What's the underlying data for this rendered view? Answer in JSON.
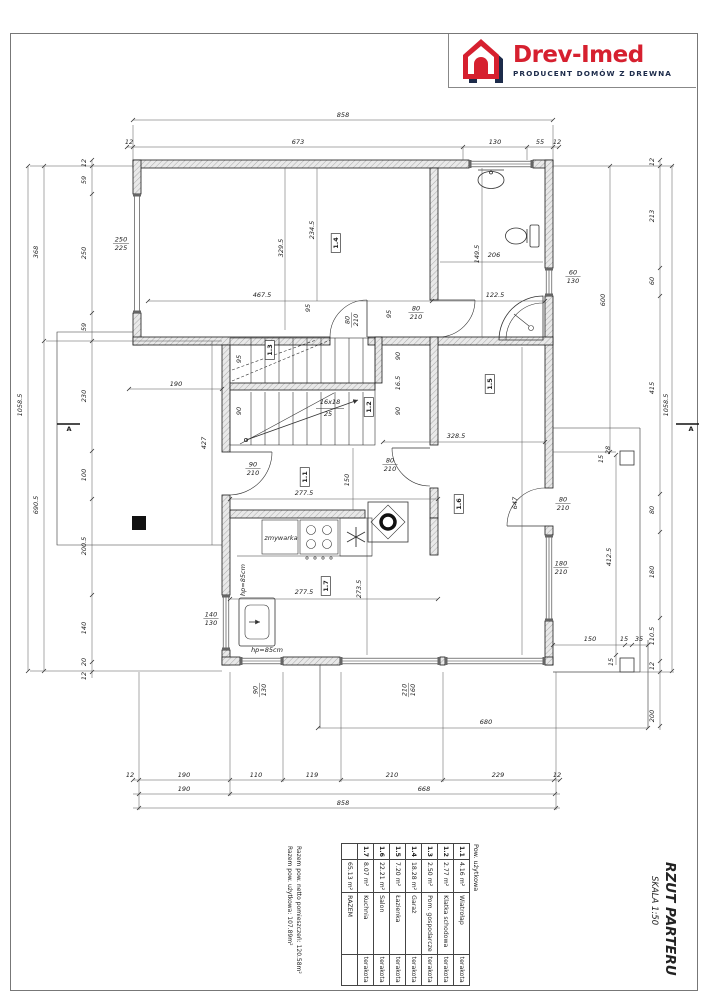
{
  "logo": {
    "brand": "Drev-Imed",
    "tagline": "PRODUCENT DOMÓW Z DREWNA",
    "brand_color": "#d6202f",
    "tagline_color": "#1c2b4a"
  },
  "title_block": {
    "title": "RZUT PARTERU",
    "scale": "SKALA 1:50"
  },
  "summary": {
    "line1": "Razem pow. netto pomieszczeń: 120.58m²",
    "line2": "Razem pow. użytkowa: 107.89m²"
  },
  "area_table": {
    "caption": "Pow. użytkowa",
    "rows": [
      {
        "nr": "1.1",
        "name": "Wiatrołap",
        "area": "4.16 m²",
        "finish": "terakota"
      },
      {
        "nr": "1.2",
        "name": "Klatka schodowa",
        "area": "2.77 m²",
        "finish": "terakota"
      },
      {
        "nr": "1.3",
        "name": "Pom. gospodarcze",
        "area": "2.50 m²",
        "finish": "terakota"
      },
      {
        "nr": "1.4",
        "name": "Garaż",
        "area": "18.28 m²",
        "finish": "terakota"
      },
      {
        "nr": "1.5",
        "name": "Łazienka",
        "area": "7.20 m²",
        "finish": "terakota"
      },
      {
        "nr": "1.6",
        "name": "Salon",
        "area": "22.21 m²",
        "finish": "terakota"
      },
      {
        "nr": "1.7",
        "name": "Kuchnia",
        "area": "8.07 m²",
        "finish": "terakota"
      }
    ],
    "total": {
      "label": "RAZEM",
      "area": "65.13 m²"
    }
  },
  "plan": {
    "stair_note": "16x18 / 25",
    "labels": [
      {
        "t": "858",
        "x": 343,
        "y": 117
      },
      {
        "t": "12",
        "x": 129,
        "y": 144,
        "s": 5.5
      },
      {
        "t": "673",
        "x": 298,
        "y": 144
      },
      {
        "t": "130",
        "x": 495,
        "y": 144
      },
      {
        "t": "55",
        "x": 540,
        "y": 144
      },
      {
        "t": "12",
        "x": 557,
        "y": 144,
        "s": 5.5
      },
      {
        "t": "12",
        "x": 130,
        "y": 777,
        "s": 5.5
      },
      {
        "t": "190",
        "x": 184,
        "y": 777
      },
      {
        "t": "110",
        "x": 256,
        "y": 777
      },
      {
        "t": "119",
        "x": 312,
        "y": 777
      },
      {
        "t": "210",
        "x": 392,
        "y": 777
      },
      {
        "t": "229",
        "x": 498,
        "y": 777
      },
      {
        "t": "12",
        "x": 557,
        "y": 777,
        "s": 5.5
      },
      {
        "t": "190",
        "x": 184,
        "y": 791
      },
      {
        "t": "668",
        "x": 424,
        "y": 791
      },
      {
        "t": "858",
        "x": 343,
        "y": 805
      },
      {
        "t": "680",
        "x": 486,
        "y": 724
      },
      {
        "t": "90",
        "t2": "130",
        "x": 259,
        "y": 690,
        "r": -90,
        "s": 5.5
      },
      {
        "t": "210",
        "t2": "160",
        "x": 408,
        "y": 690,
        "r": -90,
        "s": 5.5
      },
      {
        "t": "12",
        "x": 86,
        "y": 163,
        "r": -90,
        "s": 5
      },
      {
        "t": "59",
        "x": 86,
        "y": 180,
        "r": -90
      },
      {
        "t": "250",
        "x": 86,
        "y": 253,
        "r": -90
      },
      {
        "t": "59",
        "x": 86,
        "y": 327,
        "r": -90
      },
      {
        "t": "230",
        "x": 86,
        "y": 396,
        "r": -90
      },
      {
        "t": "100",
        "x": 86,
        "y": 475,
        "r": -90
      },
      {
        "t": "200.5",
        "x": 86,
        "y": 546,
        "r": -90
      },
      {
        "t": "140",
        "x": 86,
        "y": 628,
        "r": -90
      },
      {
        "t": "20",
        "x": 86,
        "y": 662,
        "r": -90,
        "s": 5
      },
      {
        "t": "12",
        "x": 86,
        "y": 676,
        "r": -90,
        "s": 5
      },
      {
        "t": "368",
        "x": 38,
        "y": 252,
        "r": -90
      },
      {
        "t": "690.5",
        "x": 38,
        "y": 505,
        "r": -90
      },
      {
        "t": "1058.5",
        "x": 22,
        "y": 405,
        "r": -90
      },
      {
        "t": "600",
        "x": 605,
        "y": 300,
        "r": -90
      },
      {
        "t": "12",
        "x": 654,
        "y": 162,
        "r": -90,
        "s": 5
      },
      {
        "t": "213",
        "x": 654,
        "y": 216,
        "r": -90
      },
      {
        "t": "60",
        "x": 654,
        "y": 281,
        "r": -90
      },
      {
        "t": "415",
        "x": 654,
        "y": 388,
        "r": -90
      },
      {
        "t": "80",
        "x": 654,
        "y": 510,
        "r": -90
      },
      {
        "t": "180",
        "x": 654,
        "y": 572,
        "r": -90
      },
      {
        "t": "110.5",
        "x": 654,
        "y": 636,
        "r": -90,
        "s": 5.5
      },
      {
        "t": "12",
        "x": 654,
        "y": 666,
        "r": -90,
        "s": 5
      },
      {
        "t": "200",
        "x": 654,
        "y": 716,
        "r": -90
      },
      {
        "t": "412.5",
        "x": 611,
        "y": 557,
        "r": -90
      },
      {
        "t": "1058.5",
        "x": 668,
        "y": 405,
        "r": -90
      },
      {
        "t": "28",
        "x": 610,
        "y": 450,
        "r": -90,
        "s": 5
      },
      {
        "t": "15",
        "x": 603,
        "y": 459,
        "r": -90,
        "s": 5
      },
      {
        "t": "150",
        "x": 590,
        "y": 641,
        "s": 6
      },
      {
        "t": "15",
        "x": 624,
        "y": 641,
        "s": 5
      },
      {
        "t": "35",
        "x": 639,
        "y": 641,
        "s": 5.5
      },
      {
        "t": "15",
        "x": 613,
        "y": 662,
        "r": -90,
        "s": 5
      },
      {
        "t": "250",
        "t2": "225",
        "x": 121,
        "y": 243
      },
      {
        "t": "60",
        "t2": "130",
        "x": 573,
        "y": 276,
        "s": 6
      },
      {
        "t": "80",
        "t2": "210",
        "x": 563,
        "y": 503,
        "s": 6
      },
      {
        "t": "180",
        "t2": "210",
        "x": 561,
        "y": 567,
        "s": 6
      },
      {
        "t": "140",
        "t2": "130",
        "x": 211,
        "y": 618,
        "s": 6
      },
      {
        "t": "80",
        "t2": "210",
        "x": 416,
        "y": 312,
        "s": 6
      },
      {
        "t": "80",
        "t2": "210",
        "x": 351,
        "y": 320,
        "r": -90,
        "s": 6
      },
      {
        "t": "90",
        "t2": "210",
        "x": 253,
        "y": 468,
        "s": 6
      },
      {
        "t": "80",
        "t2": "210",
        "x": 390,
        "y": 464,
        "s": 6
      },
      {
        "t": "467.5",
        "x": 262,
        "y": 297
      },
      {
        "t": "122.5",
        "x": 495,
        "y": 297
      },
      {
        "t": "234.5",
        "x": 314,
        "y": 230,
        "r": -90
      },
      {
        "t": "329.5",
        "x": 283,
        "y": 248,
        "r": -90
      },
      {
        "t": "95",
        "x": 310,
        "y": 308,
        "r": -90,
        "s": 5.5
      },
      {
        "t": "95",
        "x": 391,
        "y": 314,
        "r": -90,
        "s": 5.5
      },
      {
        "t": "16x18",
        "x": 330,
        "y": 404,
        "s": 6
      },
      {
        "t": "25",
        "x": 328,
        "y": 416,
        "s": 6
      },
      {
        "t": "95",
        "x": 241,
        "y": 359,
        "r": -90,
        "s": 5.5
      },
      {
        "t": "90",
        "x": 241,
        "y": 411,
        "r": -90,
        "s": 5.5
      },
      {
        "t": "90",
        "x": 400,
        "y": 356,
        "r": -90,
        "s": 5.5
      },
      {
        "t": "16.5",
        "x": 400,
        "y": 383,
        "r": -90,
        "s": 5
      },
      {
        "t": "90",
        "x": 400,
        "y": 411,
        "r": -90,
        "s": 5.5
      },
      {
        "t": "190",
        "x": 176,
        "y": 386
      },
      {
        "t": "427",
        "x": 206,
        "y": 443,
        "r": -90
      },
      {
        "t": "277.5",
        "x": 304,
        "y": 495
      },
      {
        "t": "150",
        "x": 349,
        "y": 480,
        "r": -90,
        "s": 5.5
      },
      {
        "t": "277.5",
        "x": 304,
        "y": 594
      },
      {
        "t": "273.5",
        "x": 361,
        "y": 589,
        "r": -90
      },
      {
        "t": "328.5",
        "x": 456,
        "y": 438
      },
      {
        "t": "647",
        "x": 517,
        "y": 503,
        "r": -90
      },
      {
        "t": "149.5",
        "x": 479,
        "y": 254,
        "r": -90,
        "s": 5.5
      },
      {
        "t": "206",
        "x": 494,
        "y": 257,
        "s": 6
      },
      {
        "t": "zmywarka",
        "x": 281,
        "y": 540,
        "s": 4.5
      },
      {
        "t": "hp=85cm",
        "x": 245,
        "y": 580,
        "r": -90,
        "s": 5
      },
      {
        "t": "hp=85cm",
        "x": 267,
        "y": 652,
        "s": 5
      },
      {
        "t": "1.4",
        "x": 338,
        "y": 243,
        "r": -90,
        "b": 1,
        "box": 1
      },
      {
        "t": "1.5",
        "x": 492,
        "y": 384,
        "r": -90,
        "b": 1,
        "box": 1
      },
      {
        "t": "1.3",
        "x": 272,
        "y": 350,
        "r": -90,
        "b": 1,
        "box": 1
      },
      {
        "t": "1.2",
        "x": 371,
        "y": 407,
        "r": -90,
        "b": 1,
        "box": 1
      },
      {
        "t": "1.1",
        "x": 307,
        "y": 477,
        "r": -90,
        "b": 1,
        "box": 1
      },
      {
        "t": "1.7",
        "x": 328,
        "y": 586,
        "r": -90,
        "b": 1,
        "box": 1
      },
      {
        "t": "1.6",
        "x": 461,
        "y": 504,
        "r": -90,
        "b": 1,
        "box": 1
      },
      {
        "t": "A",
        "x": 69,
        "y": 431,
        "s": 10,
        "b": 1,
        "i": 1
      },
      {
        "t": "A",
        "x": 691,
        "y": 431,
        "s": 10,
        "b": 1,
        "i": 1
      }
    ]
  }
}
